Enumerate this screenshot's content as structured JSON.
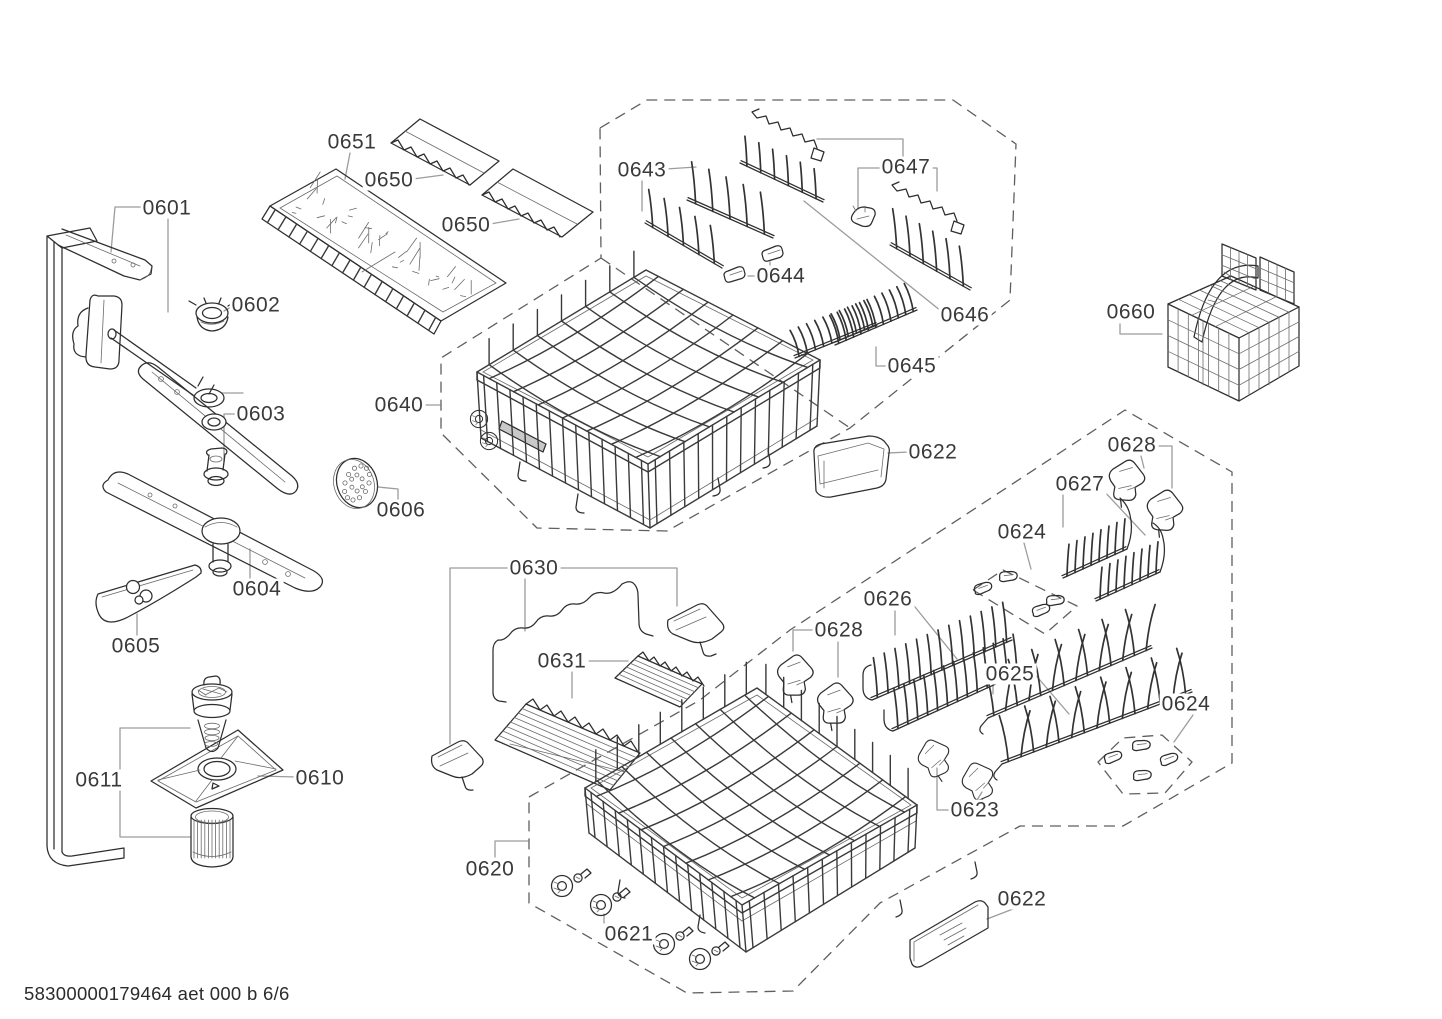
{
  "page": {
    "footer": "58300000179464 aet 000 b 6/6"
  },
  "diagram": {
    "colors": {
      "background": "#ffffff",
      "line": "#2e2e2e",
      "leader": "#9c9c9c",
      "dashed": "#5f5f5f",
      "label_text": "#3a3a3a"
    },
    "labels": [
      {
        "part": "0601",
        "x": 167,
        "y": 208
      },
      {
        "part": "0602",
        "x": 256,
        "y": 305
      },
      {
        "part": "0603",
        "x": 261,
        "y": 414
      },
      {
        "part": "0604",
        "x": 257,
        "y": 589
      },
      {
        "part": "0605",
        "x": 136,
        "y": 646
      },
      {
        "part": "0606",
        "x": 401,
        "y": 510
      },
      {
        "part": "0610",
        "x": 320,
        "y": 778
      },
      {
        "part": "0611",
        "x": 99,
        "y": 780
      },
      {
        "part": "0620",
        "x": 490,
        "y": 869
      },
      {
        "part": "0621",
        "x": 629,
        "y": 934
      },
      {
        "part": "0622",
        "x": 933,
        "y": 452
      },
      {
        "part": "0622",
        "x": 1022,
        "y": 899
      },
      {
        "part": "0623",
        "x": 975,
        "y": 810
      },
      {
        "part": "0624",
        "x": 1022,
        "y": 532
      },
      {
        "part": "0624",
        "x": 1186,
        "y": 704
      },
      {
        "part": "0625",
        "x": 1010,
        "y": 674
      },
      {
        "part": "0626",
        "x": 888,
        "y": 599
      },
      {
        "part": "0627",
        "x": 1080,
        "y": 484
      },
      {
        "part": "0628",
        "x": 1132,
        "y": 445
      },
      {
        "part": "0628",
        "x": 839,
        "y": 630
      },
      {
        "part": "0630",
        "x": 534,
        "y": 568
      },
      {
        "part": "0631",
        "x": 562,
        "y": 661
      },
      {
        "part": "0640",
        "x": 399,
        "y": 405
      },
      {
        "part": "0643",
        "x": 642,
        "y": 170
      },
      {
        "part": "0644",
        "x": 781,
        "y": 276
      },
      {
        "part": "0645",
        "x": 912,
        "y": 366
      },
      {
        "part": "0646",
        "x": 965,
        "y": 315
      },
      {
        "part": "0647",
        "x": 906,
        "y": 167
      },
      {
        "part": "0650",
        "x": 389,
        "y": 180
      },
      {
        "part": "0650",
        "x": 466,
        "y": 225
      },
      {
        "part": "0651",
        "x": 352,
        "y": 142
      },
      {
        "part": "0660",
        "x": 1131,
        "y": 312
      }
    ]
  }
}
